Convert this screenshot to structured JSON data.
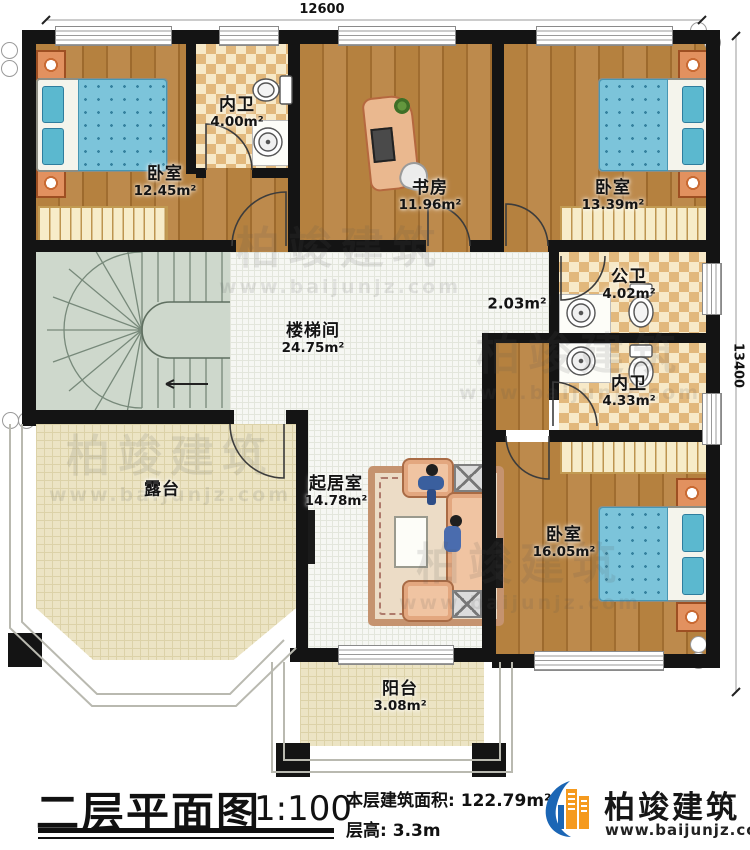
{
  "plan": {
    "dimensions": {
      "top": "12600",
      "right": "13400"
    },
    "rooms": {
      "bedroom_tl": {
        "name": "卧室",
        "area": "12.45m²"
      },
      "bath_top": {
        "name": "内卫",
        "area": "4.00m²"
      },
      "study": {
        "name": "书房",
        "area": "11.96m²"
      },
      "bedroom_tr": {
        "name": "卧室",
        "area": "13.39m²"
      },
      "stairwell": {
        "name": "楼梯间",
        "area": "24.75m²"
      },
      "corridor": {
        "area": "2.03m²"
      },
      "bath_public": {
        "name": "公卫",
        "area": "4.02m²"
      },
      "bath_inner": {
        "name": "内卫",
        "area": "4.33m²"
      },
      "terrace": {
        "name": "露台"
      },
      "living": {
        "name": "起居室",
        "area": "14.78m²"
      },
      "bedroom_br": {
        "name": "卧室",
        "area": "16.05m²"
      },
      "balcony": {
        "name": "阳台",
        "area": "3.08m²"
      }
    }
  },
  "footer": {
    "title": "二层平面图",
    "scale": "1:100",
    "area_label": "本层建筑面积:",
    "area_value": "122.79m²",
    "floor_height_label": "层高:",
    "floor_height_value": "3.3m"
  },
  "logo": {
    "company": "柏竣建筑",
    "website": "www.baijunjz.com"
  },
  "watermark": {
    "company": "柏竣建筑",
    "website": "www.baijunjz.com"
  },
  "colors": {
    "wall": "#141414",
    "wood": "#b5813f",
    "bath_checker": "#e2b87c",
    "tile": "#f6f7f3",
    "terrace": "#ece4c4",
    "stair": "#ced8cc",
    "bed_blue": "#7cc4da",
    "logo_blue": "#1b66b5",
    "logo_orange": "#f59a1e"
  }
}
